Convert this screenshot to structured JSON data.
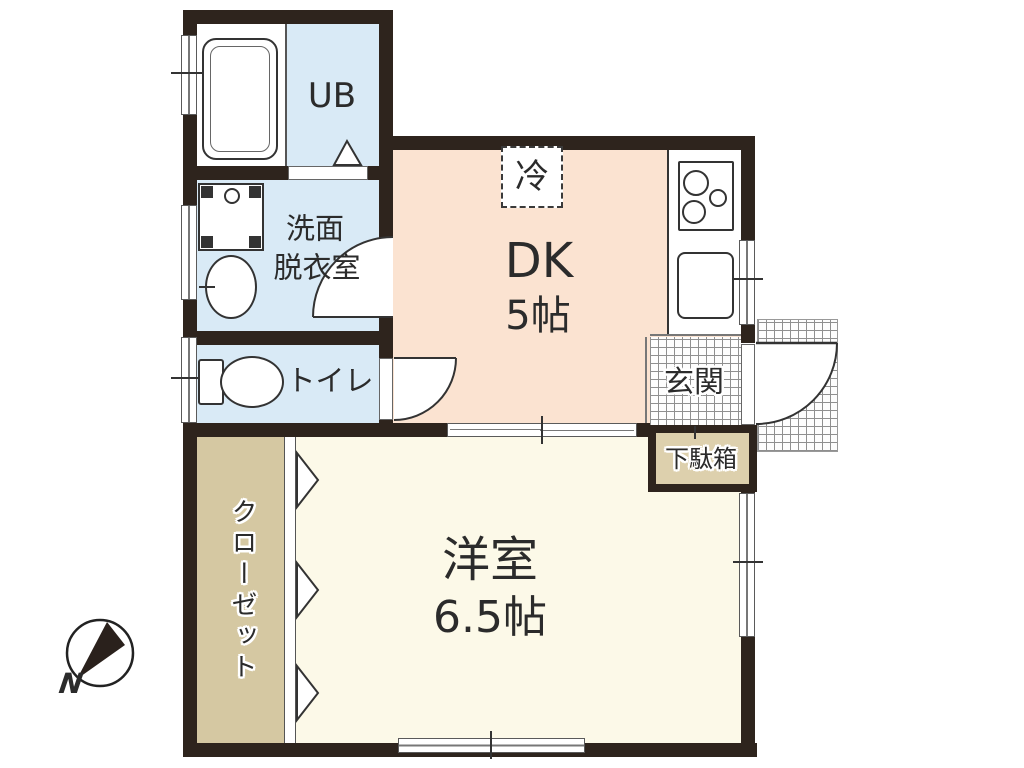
{
  "title": "apartment-floor-plan",
  "rooms": {
    "unit_bath": {
      "label": "UB"
    },
    "washroom": {
      "line1": "洗面",
      "line2": "脱衣室"
    },
    "toilet": {
      "label": "トイレ"
    },
    "dining_kitchen": {
      "label": "DK",
      "size": "5帖"
    },
    "refrigerator": {
      "label": "冷"
    },
    "entrance": {
      "label": "玄関"
    },
    "shoe_cabinet": {
      "label": "下駄箱"
    },
    "closet": {
      "label": "クローゼット"
    },
    "western_room": {
      "label": "洋室",
      "size": "6.5帖"
    }
  },
  "compass": {
    "label": "N"
  },
  "fixtures": [
    "bathtub-icon",
    "washing-machine-pan-icon",
    "wash-basin-icon",
    "toilet-bowl-icon",
    "gas-stove-icon",
    "kitchen-sink-icon",
    "folding-door-icon",
    "swing-door-icon",
    "sliding-door-icon",
    "sliding-window-icon"
  ],
  "colors": {
    "wall": "#2e241d",
    "water_room_bg": "#d9eaf6",
    "dk_bg": "#fbe3d1",
    "room_bg": "#fcf9e8",
    "closet_bg": "#d5c8a2",
    "cabinet_bg": "#ddd0ad",
    "grid_line": "#8f8f8f",
    "ink": "#2b2b2b"
  }
}
